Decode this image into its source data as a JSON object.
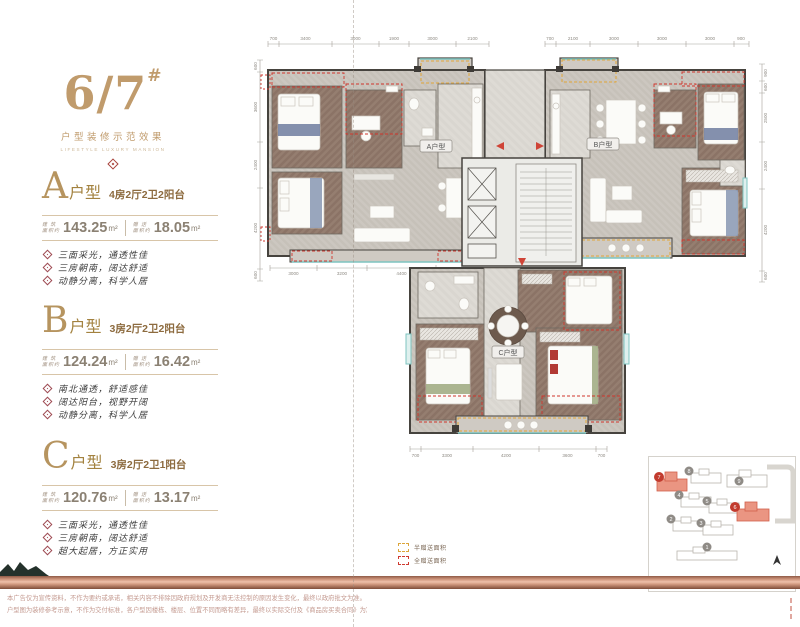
{
  "brand": {
    "building_no": "6/7",
    "hash": "#",
    "subtitle": "户型装修示范效果",
    "subtitle_en": "LIFESTYLE LUXURY MANSION"
  },
  "units": [
    {
      "letter": "A",
      "suffix": "户型",
      "spec": "4房2厅2卫2阳台",
      "area_label_top": "建 筑",
      "area_label_bottom": "面积约",
      "area_value": "143.25",
      "area_unit": "m²",
      "gift_label_top": "赠 送",
      "gift_label_bottom": "面积约",
      "gift_value": "18.05",
      "gift_unit": "m²",
      "features": [
        "三面采光，通透性佳",
        "三房朝南，阔达舒适",
        "动静分离，科学人居"
      ]
    },
    {
      "letter": "B",
      "suffix": "户型",
      "spec": "3房2厅2卫2阳台",
      "area_label_top": "建 筑",
      "area_label_bottom": "面积约",
      "area_value": "124.24",
      "area_unit": "m²",
      "gift_label_top": "赠 送",
      "gift_label_bottom": "面积约",
      "gift_value": "16.42",
      "gift_unit": "m²",
      "features": [
        "南北通透，舒适感佳",
        "阔达阳台，视野开阔",
        "动静分离，科学人居"
      ]
    },
    {
      "letter": "C",
      "suffix": "户型",
      "spec": "3房2厅2卫1阳台",
      "area_label_top": "建 筑",
      "area_label_bottom": "面积约",
      "area_value": "120.76",
      "area_unit": "m²",
      "gift_label_top": "赠 送",
      "gift_label_bottom": "面积约",
      "gift_value": "13.17",
      "gift_unit": "m²",
      "features": [
        "三面采光，通透性佳",
        "三房朝南，阔达舒适",
        "超大起居，方正实用"
      ]
    }
  ],
  "plan": {
    "labels": {
      "a": "A户型",
      "b": "B户型",
      "c": "C户型"
    },
    "dims": {
      "top_left": [
        "700",
        "3400",
        "3000",
        "1900",
        "3000",
        "2100"
      ],
      "top_right": [
        "700",
        "2100",
        "3000",
        "3000",
        "3000",
        "900"
      ],
      "left": [
        "600",
        "3600",
        "2400",
        "4200",
        "600"
      ],
      "right": [
        "900",
        "600",
        "2500",
        "2400",
        "4200",
        "600"
      ],
      "bottom_a": [
        "3000",
        "3200",
        "4400"
      ],
      "bottom_c": [
        "700",
        "3300",
        "4200",
        "3600",
        "700"
      ]
    }
  },
  "legend": {
    "half": "半赠送面积",
    "full": "全赠送面积"
  },
  "siteplan": {
    "b1": "1",
    "b2": "2",
    "b3": "3",
    "b4": "4",
    "b5": "5",
    "b6": "6",
    "b7": "7",
    "b8": "8",
    "b9": "9"
  },
  "footer": {
    "line1": "本广告仅为宣传资料，不作为要约或承诺，相关内容不排除因政府规划及开发商无法控制的原因发生变化，最终以政府批文为准。",
    "line2": "户型图为装修参考示意，不作为交付标准，各户型因楼栋、楼层、位置不同而略有差异，最终以实际交付及《商品房买卖合同》为准。"
  },
  "colors": {
    "accent_gold": "#bf9a6a",
    "accent_red": "#cf352c",
    "accent_yellow": "#e1a639",
    "teal": "#7fc4c0",
    "copper": "#c98f76",
    "highlight_building": "#e98f7d"
  }
}
